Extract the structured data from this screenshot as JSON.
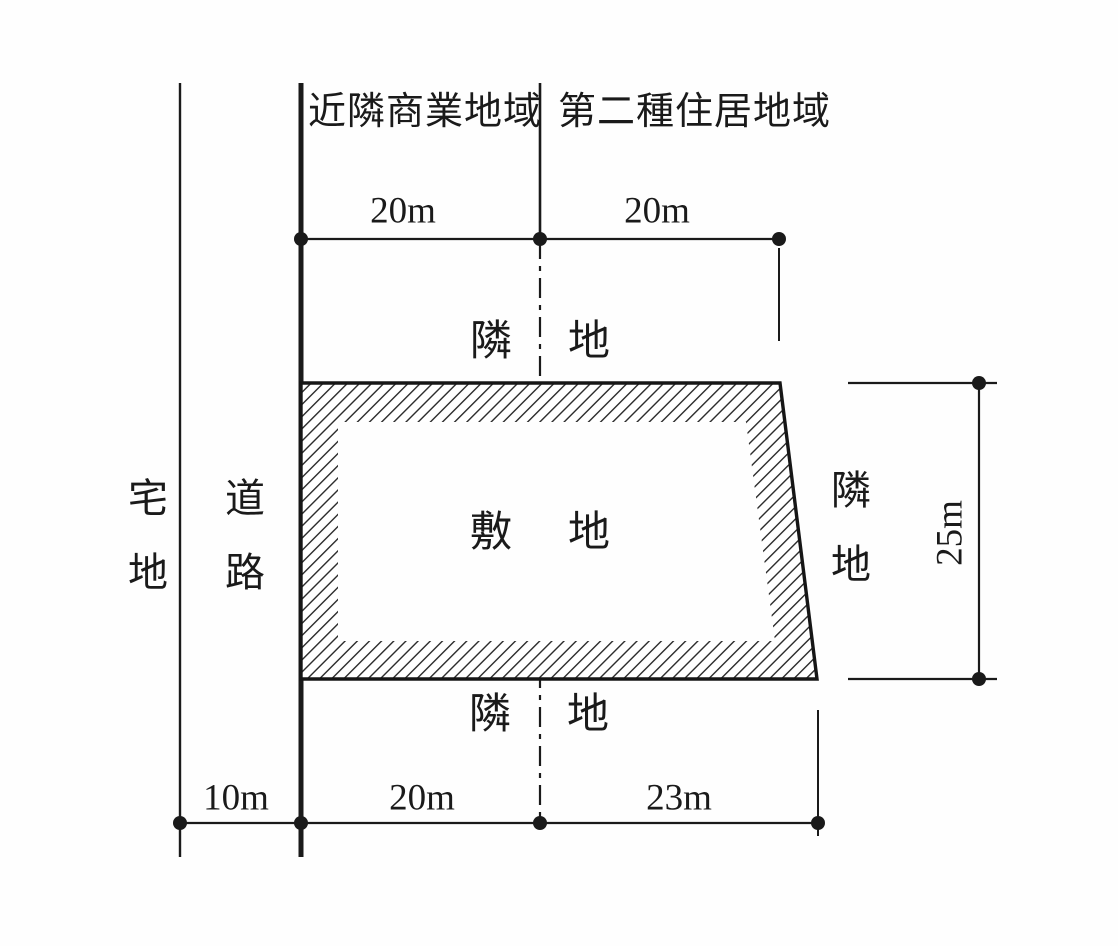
{
  "zones": {
    "left": "近隣商業地域",
    "right": "第二種住居地域"
  },
  "parcels": {
    "residential": "宅地",
    "road": "道路",
    "site": "敷地",
    "neighbor_top": "隣地",
    "neighbor_right": "隣地",
    "neighbor_bottom": "隣地"
  },
  "dimensions": {
    "top_left": "20m",
    "top_right": "20m",
    "right_side": "25m",
    "bottom_road": "10m",
    "bottom_left": "20m",
    "bottom_right": "23m"
  },
  "colors": {
    "ink": "#1a1a1a",
    "background": "#ffffff",
    "hatch": "#2b2b2b"
  }
}
